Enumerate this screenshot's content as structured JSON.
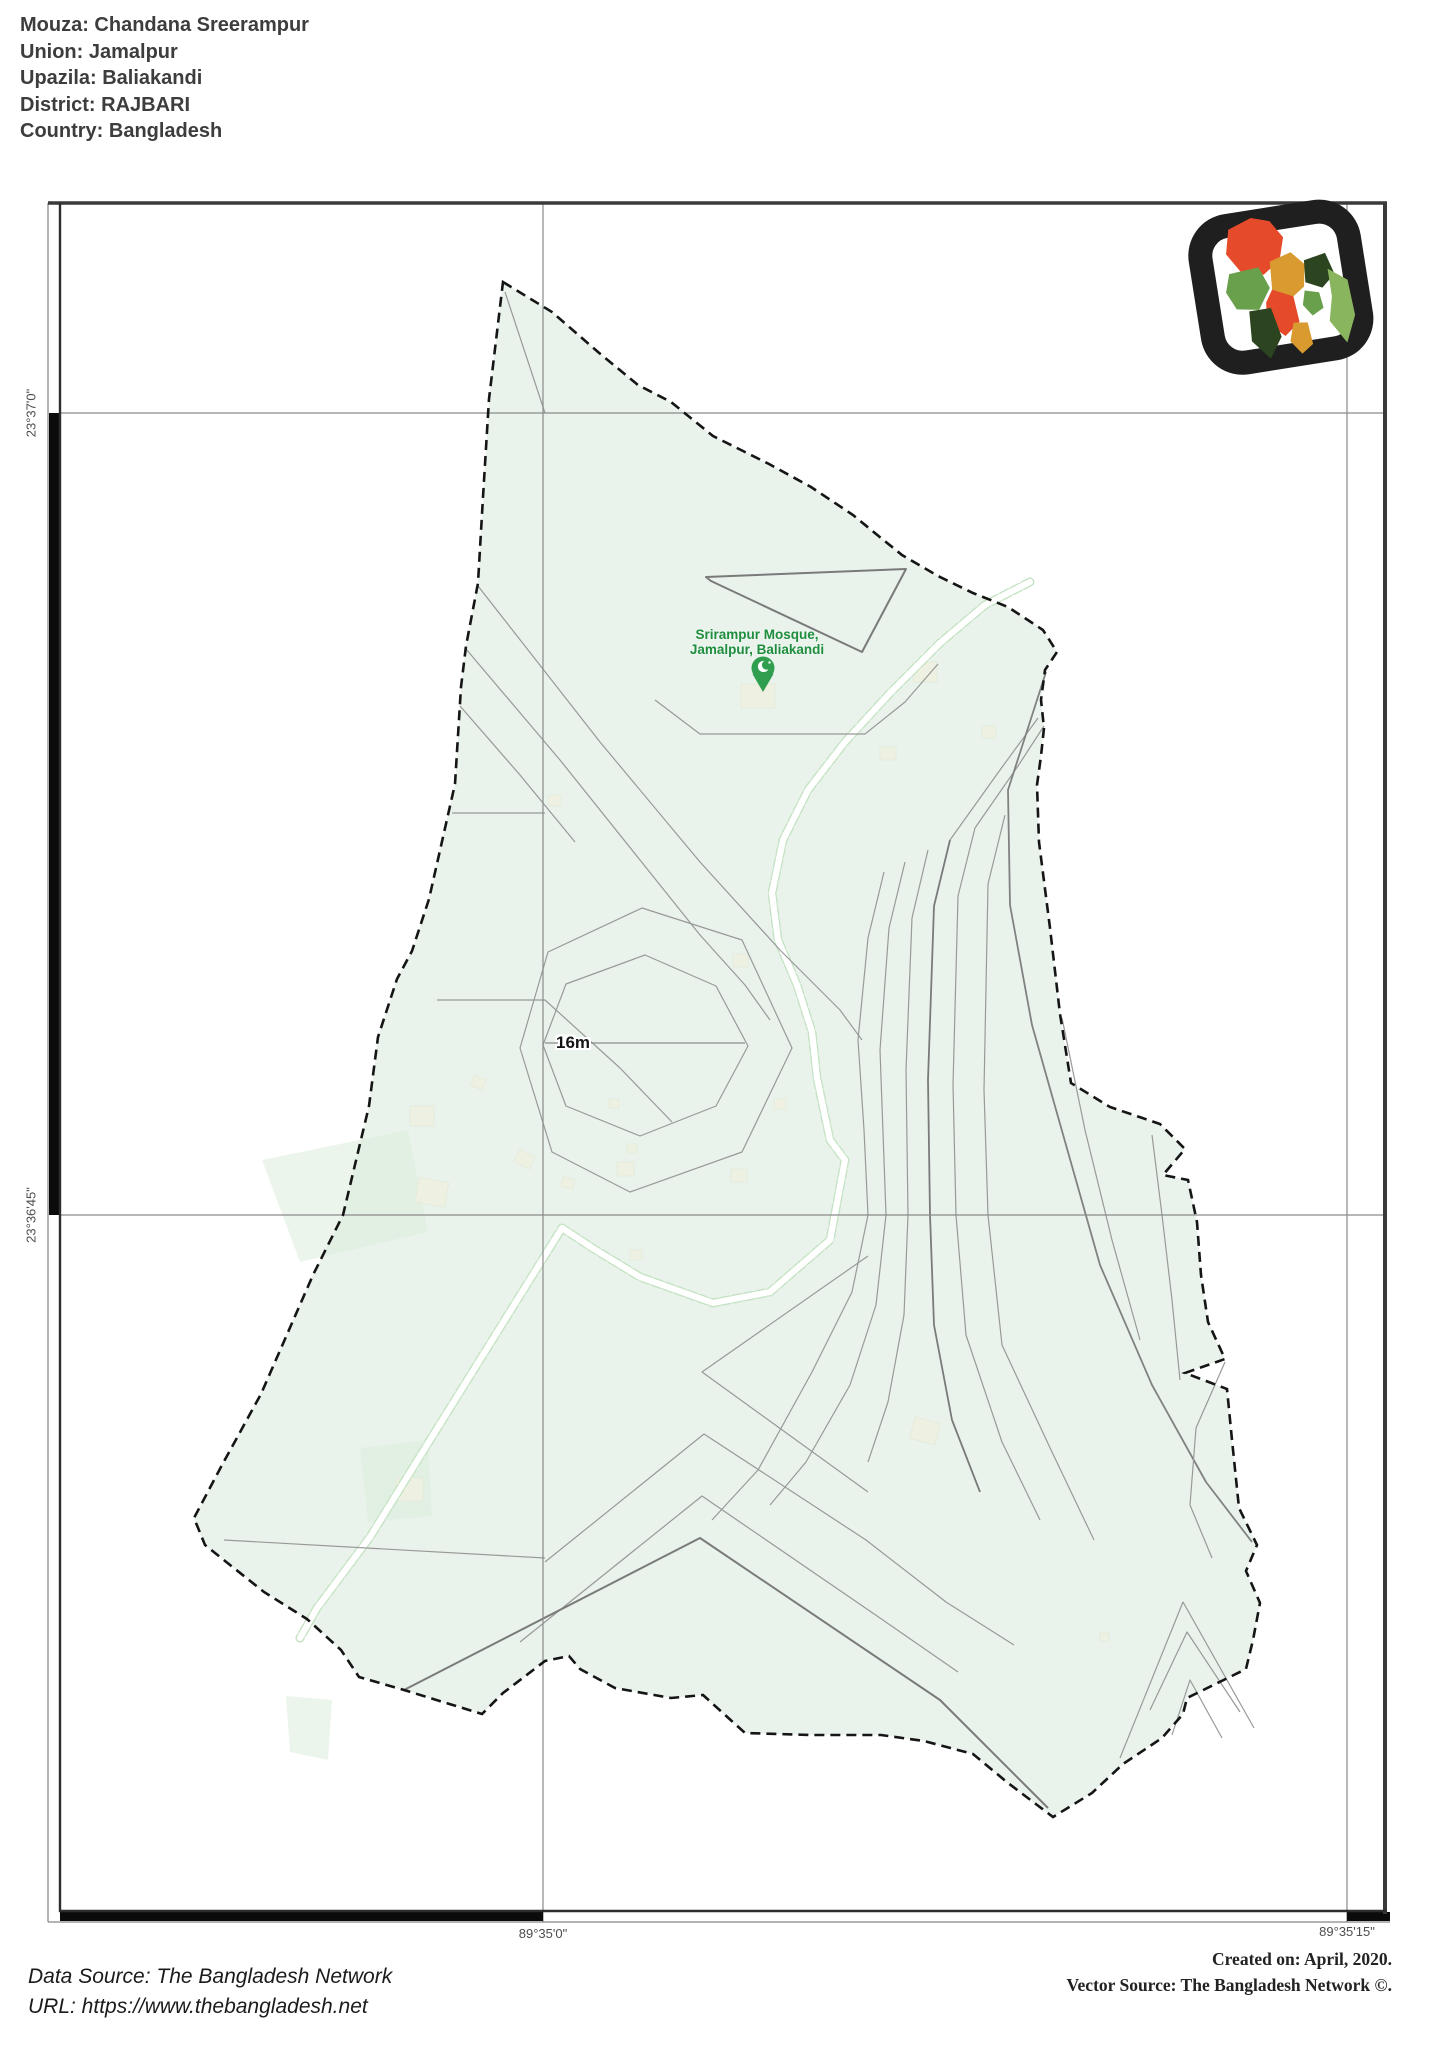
{
  "header": {
    "lines": [
      "Mouza: Chandana Sreerampur",
      "Union: Jamalpur",
      "Upazila: Baliakandi",
      "District: RAJBARI",
      "Country: Bangladesh"
    ]
  },
  "map": {
    "graticule": {
      "lat": [
        "23°37'0\"",
        "23°36'45\""
      ],
      "lon": [
        "89°35'0\"",
        "89°35'15\""
      ]
    },
    "labels": {
      "contour_elevation": "16m",
      "poi_line1": "Srirampur Mosque,",
      "poi_line2": "Jamalpur, Baliakandi"
    }
  },
  "footer": {
    "left": [
      "Data Source: The Bangladesh Network",
      "URL: https://www.thebangladesh.net"
    ],
    "right": [
      "Created on: April, 2020.",
      "Vector Source: The Bangladesh Network ©."
    ]
  },
  "colors": {
    "land": "#e9f3ec",
    "building": "#eef1e2",
    "road_fill": "#ffffff",
    "road_edge": "#c5e3c4",
    "contour": "#999999",
    "contour_dark": "#7a7a7a",
    "grid": "#8a8a8a",
    "boundary": "#151515",
    "frame": "#3a3a3a",
    "poi_green": "#1e8e3e",
    "pin_green": "#2f9e4e",
    "logo_red": "#e54b2a",
    "logo_orange": "#d99b2f",
    "logo_green": "#69a04b",
    "logo_dark_green": "#2c441f",
    "logo_light_green": "#8ab55f",
    "logo_frame": "#1f1f1f"
  }
}
